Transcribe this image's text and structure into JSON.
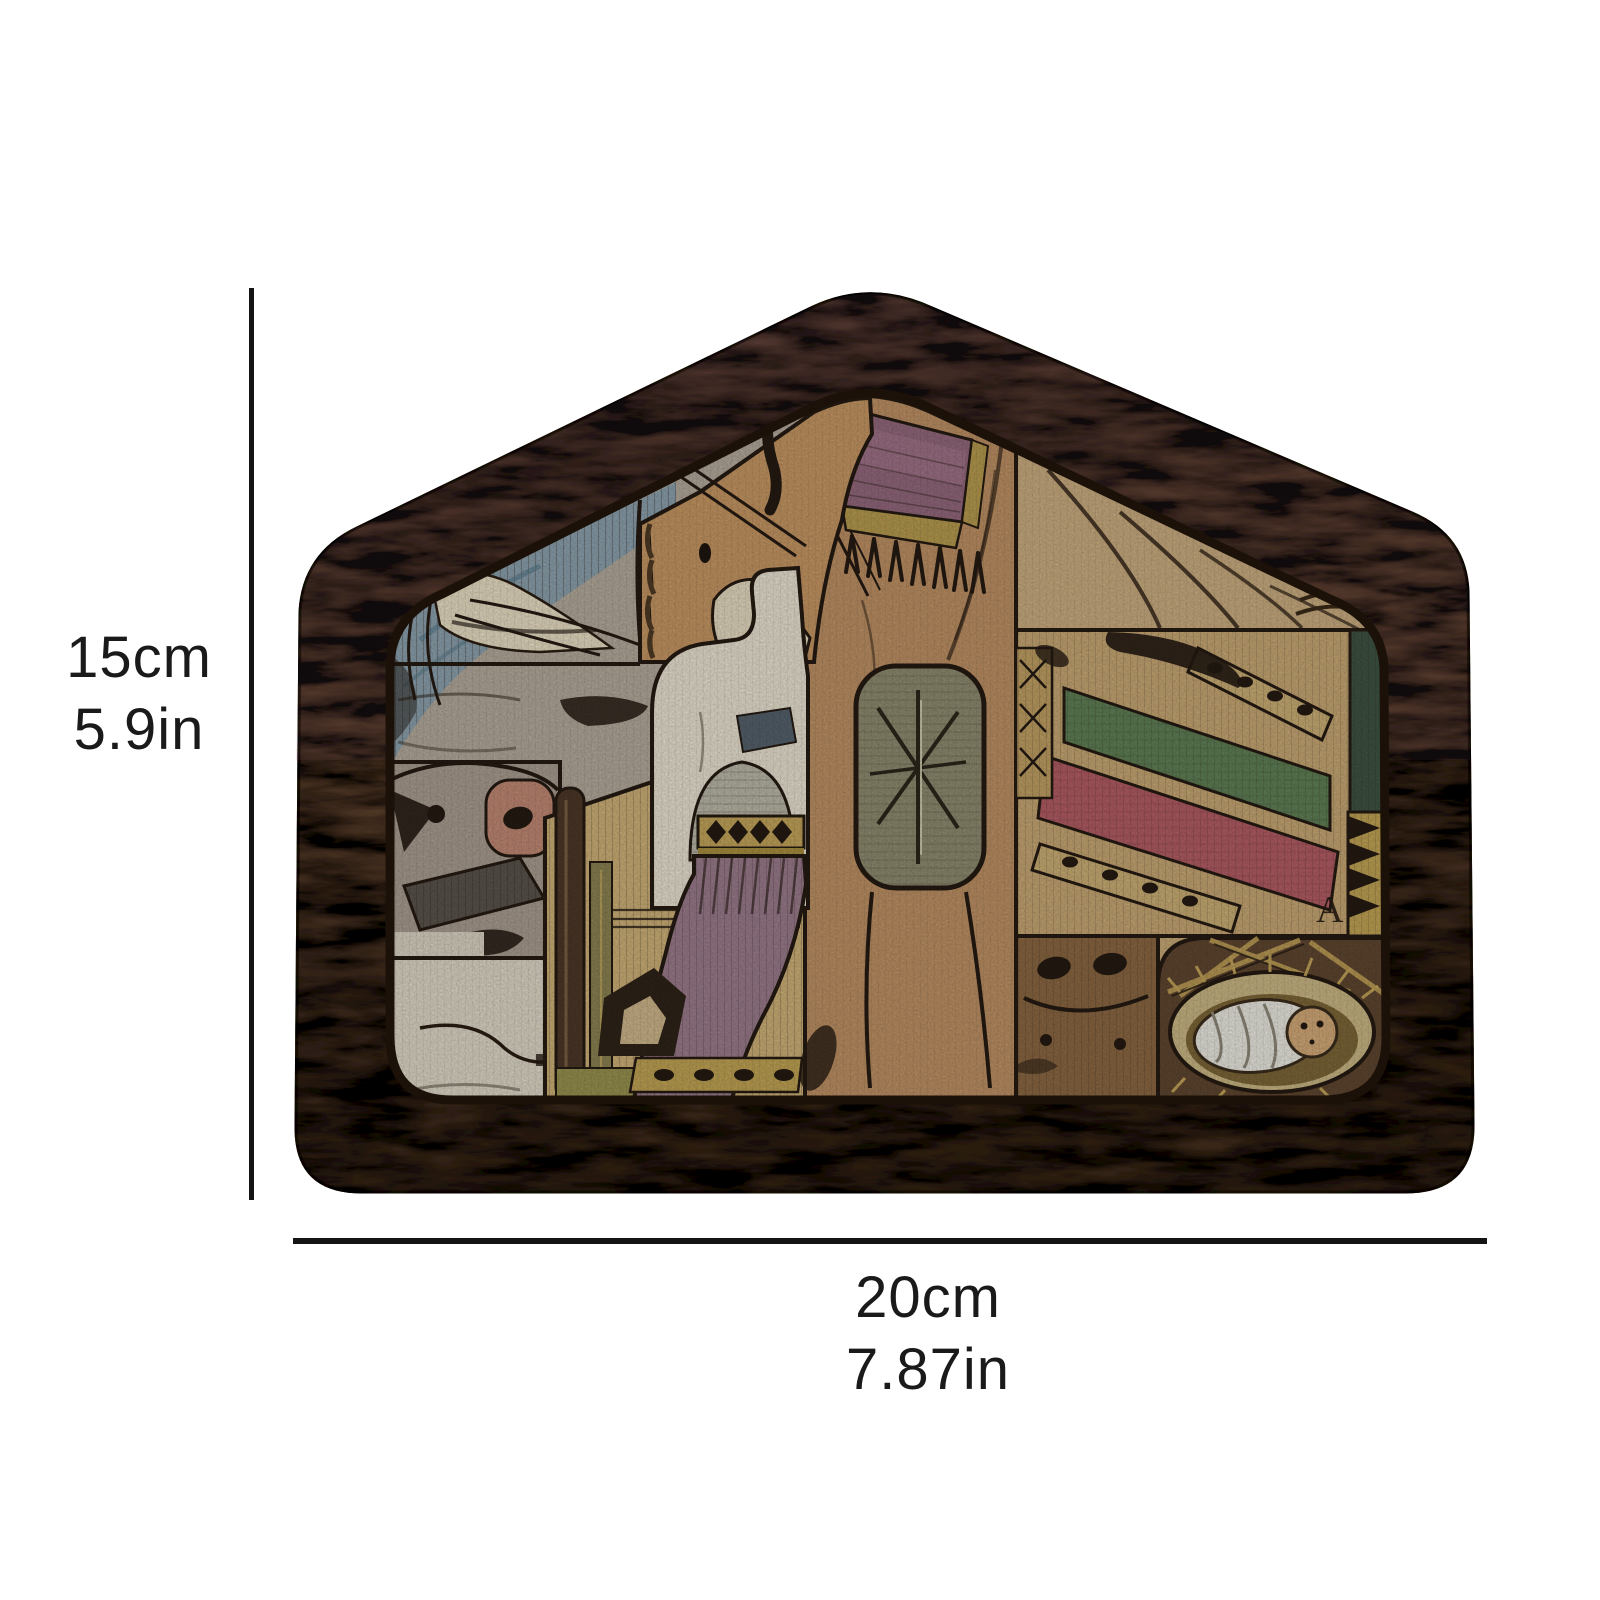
{
  "page": {
    "type": "product dimension illustration",
    "background_color": "#ffffff"
  },
  "product": {
    "name": "Wooden nativity scene puzzle",
    "frame_shape": "house-shaped walnut tray",
    "etched_letter": "A",
    "scene_elements": [
      "dove",
      "horse head with bridle",
      "camel with purple fringed saddle blanket",
      "tent curtain",
      "star of Bethlehem panel",
      "green blanket band",
      "red blanket band",
      "dotted ribbons",
      "donkey head with pink muzzle",
      "sheep",
      "wise man with gold crown and purple robe",
      "shepherd staff",
      "cow muzzle",
      "baby Jesus swaddled in a straw manger"
    ],
    "palette": {
      "frame_wood": "#5d4331",
      "frame_dark": "#3c2a1c",
      "piece_tan": "#bd9064",
      "piece_silver": "#b3a99b",
      "blanket_purple": "#92687c",
      "band_green": "#5f7f55",
      "band_red": "#b25c64",
      "straw_gold": "#c2a258",
      "swaddle_white": "#e9e7df",
      "outline": "#241a12"
    }
  },
  "dimensions": {
    "height": {
      "cm": "15cm",
      "inches": "5.9in"
    },
    "width": {
      "cm": "20cm",
      "inches": "7.87in"
    },
    "line_color": "#141414",
    "text_color": "#1a1a1a"
  }
}
